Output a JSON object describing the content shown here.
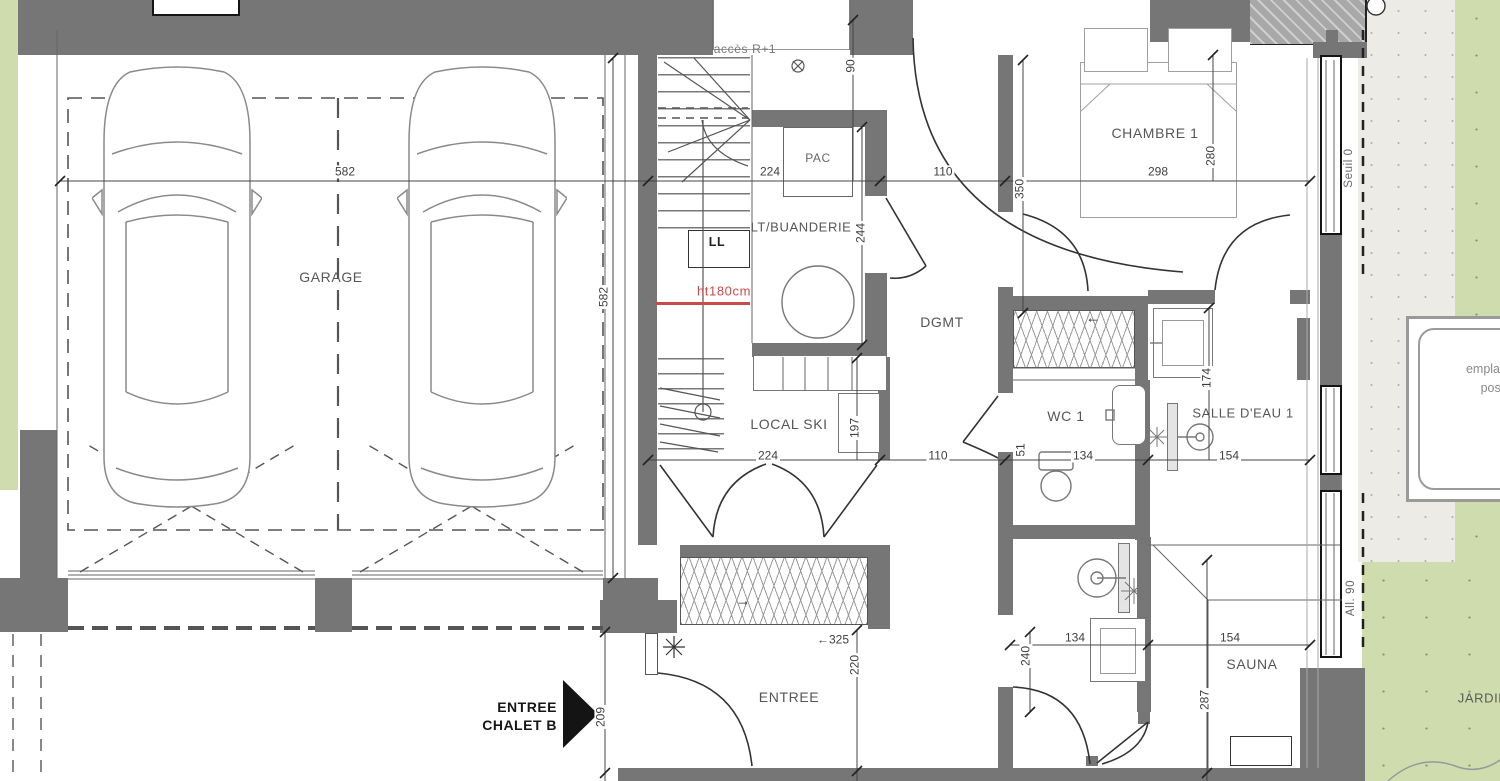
{
  "rooms": {
    "garage": "GARAGE",
    "entree": "ENTREE",
    "local_ski": "LOCAL SKI",
    "buanderie": "LT/BUANDERIE",
    "dgmt": "DGMT",
    "chambre1": "CHAMBRE 1",
    "wc1": "WC 1",
    "salle_eau1": "SALLE D'EAU 1",
    "sauna": "SAUNA",
    "jardin": "JARDIN"
  },
  "annotations": {
    "acces": "accès R+1",
    "pac": "PAC",
    "ll": "LL",
    "ht": "ht180cm",
    "entree_arrow_line1": "ENTREE",
    "entree_arrow_line2": "CHALET B",
    "seuil": "Seuil 0",
    "allege": "All. 90",
    "closet_arrow_right": "→",
    "closet_arrow_left": "←",
    "note": [
      "emplacement",
      "possible",
      "o"
    ]
  },
  "dimensions": {
    "garage_width": "582",
    "garage_depth": "582",
    "drive": "209",
    "door_top": "90",
    "buanderie_width": "224",
    "hall_top": "110",
    "chambre_width": "298",
    "chambre_depth": "280",
    "corridor": "350",
    "buanderie_depth": "244",
    "ski_width": "224",
    "ski_depth": "197",
    "hall_bottom": "110",
    "wc_offset": "51",
    "wc_width": "134",
    "sdb_width": "154",
    "sdb_depth": "174",
    "closet": "←325",
    "entree_depth": "220",
    "bath_width": "134",
    "sauna_width": "154",
    "bath_depth": "240",
    "sauna_depth": "287"
  },
  "colors": {
    "wall": "#767676",
    "wall_hatched": "#a8a8a8",
    "linework": "#555555",
    "door_arc": "#333333",
    "dimension_text": "#3f3f3f",
    "red_annotation": "#c84b4b",
    "grass": "#cfddae",
    "gravel": "#ecebe5"
  }
}
